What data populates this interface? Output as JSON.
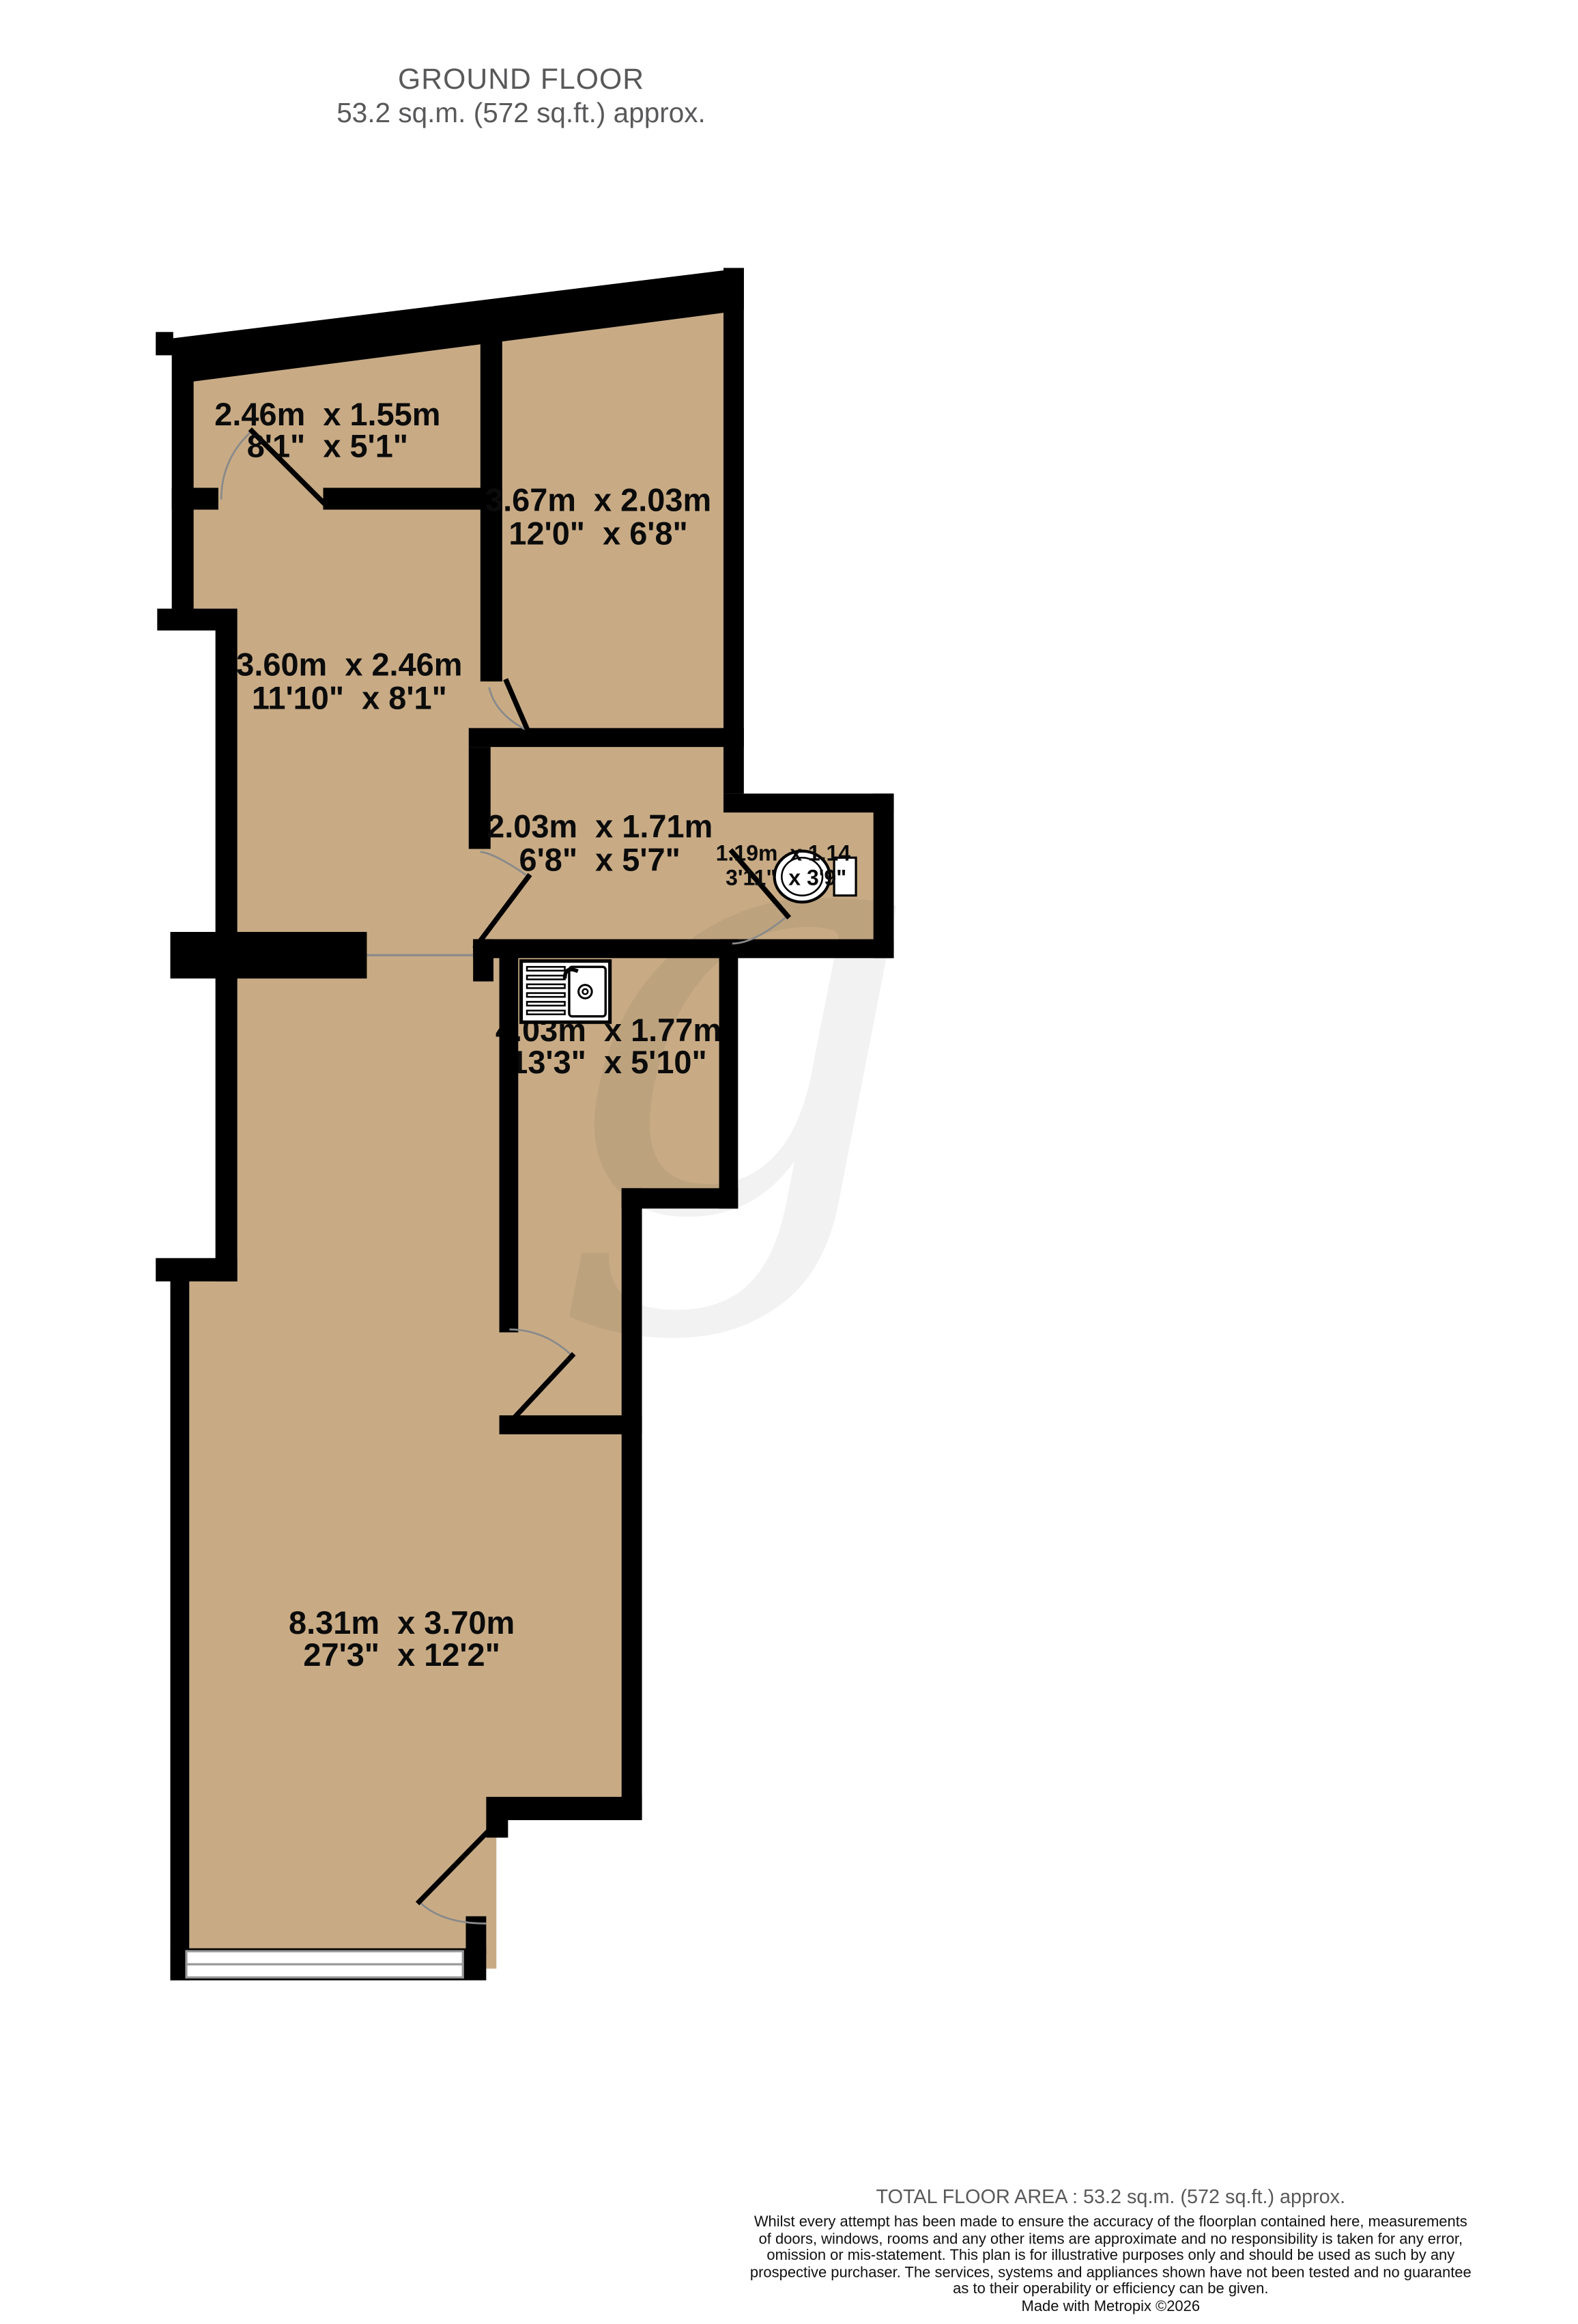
{
  "header": {
    "title": "GROUND FLOOR",
    "subtitle": "53.2 sq.m. (572 sq.ft.) approx."
  },
  "watermark": "g",
  "rooms": {
    "top_left": {
      "metric": "2.46m  x 1.55m",
      "imperial": "8'1\"  x 5'1\""
    },
    "top_right": {
      "metric": "3.67m  x 2.03m",
      "imperial": "12'0\"  x 6'8\""
    },
    "hall": {
      "metric": "3.60m  x 2.46m",
      "imperial": "11'10\"  x 8'1\""
    },
    "inner": {
      "metric": "2.03m  x 1.71m",
      "imperial": "6'8\"  x 5'7\""
    },
    "wc": {
      "metric": "1.19m  x 1.14",
      "imperial": "3'11\"  x 3'9\""
    },
    "kitchen": {
      "metric": "4.03m  x 1.77m",
      "imperial": "13'3\"  x 5'10\""
    },
    "living": {
      "metric": "8.31m  x 3.70m",
      "imperial": "27'3\"  x 12'2\""
    }
  },
  "footer": {
    "total": "TOTAL FLOOR AREA : 53.2 sq.m. (572 sq.ft.) approx.",
    "disclaimer_lines": [
      "Whilst every attempt has been made to ensure the accuracy of the floorplan contained here, measurements",
      "of doors, windows, rooms and any other items are approximate and no responsibility is taken for any error,",
      "omission or mis-statement. This plan is for illustrative purposes only and should be used as such by any",
      "prospective purchaser. The services, systems and appliances shown have not been tested and no guarantee",
      "as to their operability or efficiency can be given."
    ],
    "credit": "Made with Metropix ©2026"
  },
  "colors": {
    "floor": "#c8ab85",
    "wall": "#000000",
    "arc": "#8a8a8a",
    "muted_text": "#59595b"
  }
}
